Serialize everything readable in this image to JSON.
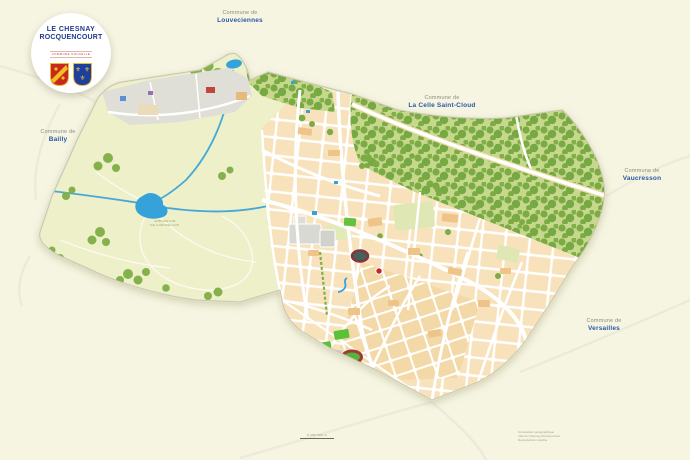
{
  "page": {
    "background_color": "#f6f5e2"
  },
  "logo": {
    "line1": "LE CHESNAY",
    "line2": "ROCQUENCOURT",
    "tagline": "COMMUNE NOUVELLE",
    "title_color": "#21398b",
    "tagline_color": "#c23a2e"
  },
  "neighbors": {
    "louveciennes": {
      "prefix": "Commune de",
      "name": "Louveciennes"
    },
    "la_celle": {
      "prefix": "Commune de",
      "name": "La Celle Saint-Cloud"
    },
    "vaucresson": {
      "prefix": "Commune de",
      "name": "Vaucresson"
    },
    "versailles": {
      "prefix": "Commune de",
      "name": "Versailles"
    },
    "bailly": {
      "prefix": "Commune de",
      "name": "Bailly"
    }
  },
  "map": {
    "area_label_line1": "ARBORETUM",
    "area_label_line2": "DE CHÈVRELOUP",
    "colors": {
      "rural_green": "#edf0c9",
      "forest_base": "#c6d88c",
      "tree_green": "#7cab45",
      "urban_block": "#f7e2bb",
      "water_blue": "#35a3d9",
      "road_white": "#ffffff",
      "marker_red": "#c5262c",
      "field_green": "#59c236",
      "label_blue": "#2a57a5",
      "label_gray": "#8b8b80"
    }
  },
  "footer": {
    "scale_label": "0   250   500 m",
    "credits": [
      "Conception cartographique",
      "Ville du Chesnay-Rocquencourt",
      "Reproduction interdite"
    ]
  }
}
